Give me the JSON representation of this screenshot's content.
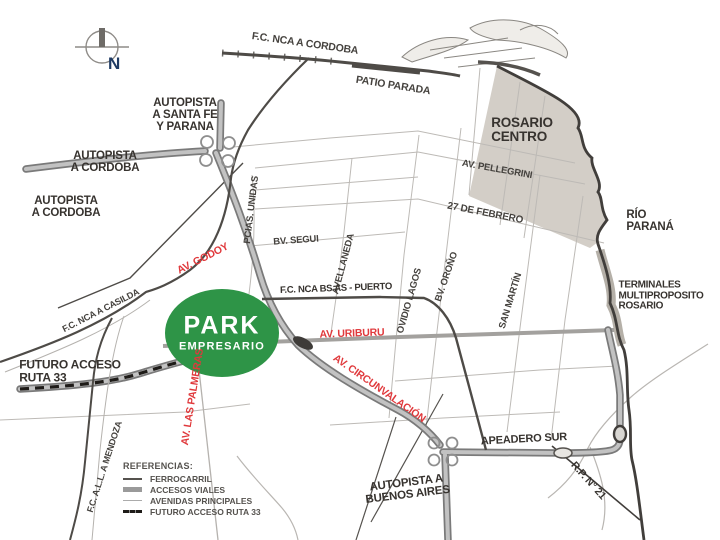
{
  "park": {
    "title": "PARK",
    "subtitle": "EMPRESARIO",
    "color": "#2E9447"
  },
  "compass": {
    "north": "N"
  },
  "highways": {
    "santafe_parana": "AUTOPISTA\nA SANTA FE\nY PARANA",
    "cordoba_1": "AUTOPISTA\nA CORDOBA",
    "cordoba_2": "AUTOPISTA\nA CORDOBA",
    "buenos_aires": "AUTOPISTA A\nBUENOS AIRES",
    "futuro_ruta33": "FUTURO ACCESO\nRUTA 33",
    "rp21": "R.P. N° 21",
    "apeadero_sur": "APEADERO SUR"
  },
  "railways": {
    "nca_cordoba": "F.C. NCA A CORDOBA",
    "patio_parada": "PATIO PARADA",
    "nca_bsas_puerto": "F.C. NCA BS AS - PUERTO",
    "nca_casilda": "F.C. NCA A CASILDA",
    "all_mendoza": "F.C. A.L.L. A MENDOZA"
  },
  "avenues": {
    "godoy": "AV. GODOY",
    "uriburu": "AV. URIBURU",
    "circunvalacion": "AV. CIRCUNVALACIÓN",
    "las_palmeras": "AV. LAS PALMERAS",
    "pellegrini": "AV. PELLEGRINI",
    "febrero_27": "27 DE FEBRERO",
    "segui": "BV. SEGUI",
    "avellaneda": "AVELLANEDA",
    "pcias_unidas": "PCIAS. UNIDAS",
    "ovidio_lagos": "OVIDIO LAGOS",
    "orono": "BV. OROÑO",
    "san_martin": "SAN MARTÍN"
  },
  "places": {
    "rosario_centro": "ROSARIO\nCENTRO",
    "rio_parana": "RÍO\nPARANÁ",
    "terminales": "TERMINALES\nMULTIPROPOSITO\nROSARIO"
  },
  "legend": {
    "title": "REFERENCIAS:",
    "items": [
      {
        "label": "FERROCARRIL"
      },
      {
        "label": "ACCESOS VIALES"
      },
      {
        "label": "AVENIDAS PRINCIPALES"
      },
      {
        "label": "FUTURO ACCESO RUTA 33"
      }
    ]
  },
  "colors": {
    "park_green": "#2E9447",
    "avenue_red": "#E0393C",
    "label_dark": "#37332F",
    "compass_navy": "#1E3A63",
    "highway_gray": "#8E8E8E",
    "centro_fill": "#CFCAC2"
  }
}
